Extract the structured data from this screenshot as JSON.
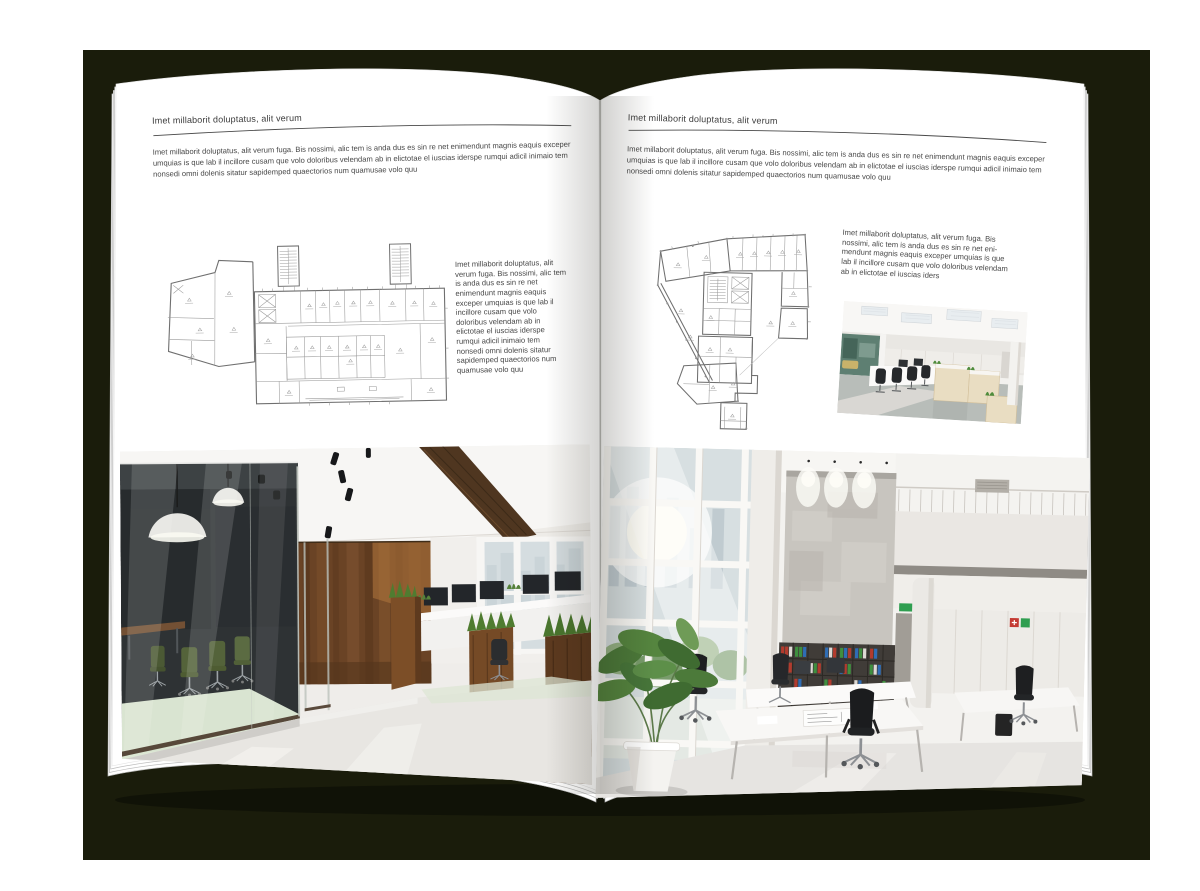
{
  "palette": {
    "backdrop": "#1a1c0b",
    "page": "#ffffff",
    "heading_text": "#3b3b3b",
    "body_text": "#474747",
    "rule_line": "#4a4a4a",
    "plan_line": "#7d7d7d",
    "wood": "#6a4325",
    "meeting_room_chair_green": "#4d5c31",
    "binder_red": "#b23b2e",
    "binder_green": "#3f8f3f",
    "binder_blue": "#2f6db5"
  },
  "left_page": {
    "header": "Imet millaborit doluptatus, alit verum",
    "intro": "Imet millaborit doluptatus, alit verum fuga. Bis nossimi, alic tem is anda dus es sin re net enimendunt magnis eaquis exceper umquias is que lab il incillore cusam que volo doloribus velendam ab in elictotae el iuscias iderspe rumqui adicil inimaio tem nonsedi omni dolenis sitatur sapidemped quaectorios num quamusae volo quu",
    "side_text": "Imet millaborit doluptatus, alit verum fuga. Bis nossimi, alic tem is anda dus es sin re net enimendunt magnis eaquis exceper umquias is que lab il incillore cusam que volo doloribus velendam ab in elictotae el iuscias iderspe rumqui adicil inimaio tem nonsedi omni dolenis sitatur sapidemped quaectorios num quamusae volo quu",
    "figures": {
      "plan": "wide-building-floor-plan",
      "photo": "office-interior-with-wood-walls-and-glass-meeting-room"
    }
  },
  "right_page": {
    "header": "Imet millaborit doluptatus, alit verum",
    "intro": "Imet millaborit doluptatus, alit verum fuga. Bis nossimi, alic tem is anda dus es sin re net enimendunt magnis eaquis exceper umquias is que lab il incillore cusam que volo doloribus velendam ab in elictotae el iuscias iderspe rumqui adicil inimaio tem nonsedi omni dolenis sitatur sapidemped quaectorios num quamusae volo quu",
    "side_text": "Imet millaborit doluptatus, alit verum fuga. Bis nossimi, alic tem is anda dus es sin re net eni-mendunt magnis eaquis exceper umquias is que lab il incillore cusam que volo doloribus velendam ab in elictotae el iuscias iders",
    "figures": {
      "plan": "wedge-building-floor-plan",
      "photo_small": "open-plan-office-workstations",
      "photo": "white-atrium-office-interior"
    }
  }
}
